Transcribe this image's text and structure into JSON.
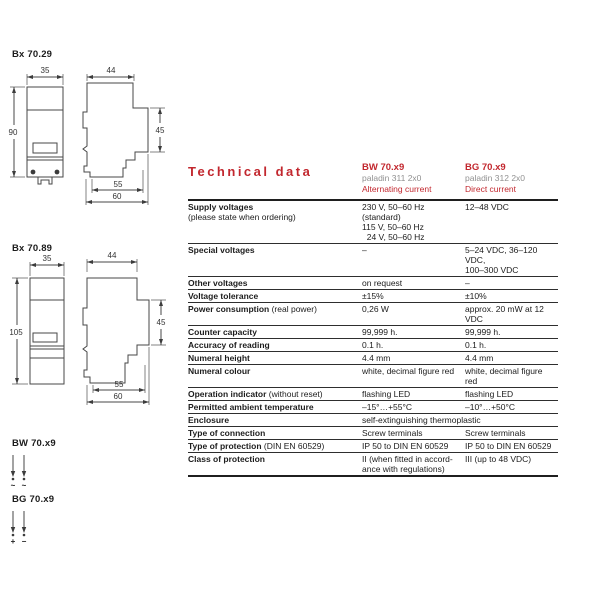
{
  "colors": {
    "red": "#c2272e",
    "gray": "#919191",
    "ink": "#1c1c1c",
    "line": "#474747"
  },
  "drawings": {
    "bx7029": {
      "label": "Bx 70.29",
      "dims": {
        "front_width": "35",
        "front_height": "90",
        "side_width": "44",
        "side_right_height": "45",
        "base_inner": "55",
        "base_outer": "60"
      }
    },
    "bx7089": {
      "label": "Bx 70.89",
      "dims": {
        "front_width": "35",
        "front_height": "105",
        "side_width": "44",
        "side_right_height": "45",
        "base_inner": "55",
        "base_outer": "60"
      }
    },
    "bw_symbol": {
      "label": "BW 70.x9",
      "terminal1": "~",
      "terminal2": "~"
    },
    "bg_symbol": {
      "label": "BG 70.x9",
      "terminal1": "+",
      "terminal2": "−"
    }
  },
  "table": {
    "title": "Technical data",
    "columns": [
      {
        "model": "BW 70.x9",
        "product": "paladin 311 2x0",
        "current": "Alternating current"
      },
      {
        "model": "BG 70.x9",
        "product": "paladin 312 2x0",
        "current": "Direct current"
      }
    ],
    "rows": [
      {
        "label": "Supply voltages",
        "note": "(please state when ordering)",
        "c1": "230 V, 50–60 Hz (standard)\n115 V, 50–60 Hz\n  24 V, 50–60 Hz",
        "c2": "12–48 VDC"
      },
      {
        "label": "Special voltages",
        "c1": "–",
        "c2": "5–24 VDC, 36–120 VDC,\n100–300 VDC"
      },
      {
        "label": "Other voltages",
        "c1": "on request",
        "c2": "–"
      },
      {
        "label": "Voltage tolerance",
        "c1": "±15%",
        "c2": "±10%"
      },
      {
        "label": "Power consumption",
        "note": " (real power)",
        "c1": "0,26 W",
        "c2": "approx. 20 mW at 12 VDC"
      },
      {
        "label": "Counter capacity",
        "c1": "99,999 h.",
        "c2": "99,999 h."
      },
      {
        "label": "Accuracy of reading",
        "c1": "0.1 h.",
        "c2": "0.1 h."
      },
      {
        "label": "Numeral height",
        "c1": "4.4 mm",
        "c2": "4.4 mm"
      },
      {
        "label": "Numeral colour",
        "c1": "white, decimal figure red",
        "c2": "white, decimal figure red"
      },
      {
        "label": "Operation indicator",
        "note": " (without reset)",
        "c1": "flashing LED",
        "c2": "flashing LED"
      },
      {
        "label": "Permitted ambient temperature",
        "c1": "–15°…+55°C",
        "c2": "–10°…+50°C"
      },
      {
        "label": "Enclosure",
        "span": "self-extinguishing thermoplastic"
      },
      {
        "label": "Type of connection",
        "c1": "Screw terminals",
        "c2": "Screw terminals"
      },
      {
        "label": "Type of protection",
        "note": " (DIN EN 60529)",
        "c1": "IP 50 to DIN EN 60529",
        "c2": "IP 50 to DIN EN 60529"
      },
      {
        "label": "Class of protection",
        "c1": "II (when fitted in accord-\nance with regulations)",
        "c2": "III (up to 48 VDC)"
      }
    ]
  }
}
